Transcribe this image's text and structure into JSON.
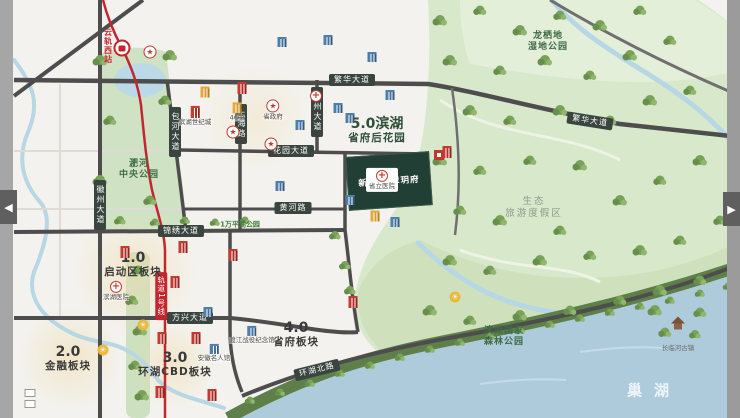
{
  "carousel": {
    "prev_label": "◀",
    "next_label": "▶"
  },
  "lake": {
    "name": "巢湖"
  },
  "project": {
    "name": "新华·翡翠玥府",
    "logo": "新华地产"
  },
  "transit": {
    "station": "云轨西站",
    "line_badge": "轨道1号线",
    "line_color": "#c2262e"
  },
  "zones": [
    {
      "num": "1.0",
      "name": "启动区板块",
      "x": 133,
      "y": 264,
      "color": "#3a3a3a"
    },
    {
      "num": "2.0",
      "name": "金融板块",
      "x": 68,
      "y": 358,
      "color": "#3a3a3a"
    },
    {
      "num": "3.0",
      "name": "环湖CBD板块",
      "x": 175,
      "y": 364,
      "color": "#3a3a3a"
    },
    {
      "num": "4.0",
      "name": "省府板块",
      "x": 296,
      "y": 334,
      "color": "#3a3a3a"
    },
    {
      "num": "5.0滨湖",
      "name": "省府后花园",
      "x": 377,
      "y": 130,
      "color": "#2e4f38"
    }
  ],
  "road_badges": [
    {
      "label": "繁华大道",
      "x": 352,
      "y": 80,
      "angle": 0
    },
    {
      "label": "繁华大道",
      "x": 590,
      "y": 121,
      "angle": 9
    },
    {
      "label": "锦绣大道",
      "x": 181,
      "y": 231,
      "angle": 0
    },
    {
      "label": "花园大道",
      "x": 291,
      "y": 151,
      "angle": 0
    },
    {
      "label": "黄河路",
      "x": 293,
      "y": 208,
      "angle": 0
    },
    {
      "label": "方兴大道",
      "x": 190,
      "y": 318,
      "angle": 0
    },
    {
      "label": "环湖北路",
      "x": 317,
      "y": 370,
      "angle": -14
    }
  ],
  "vertical_roads": [
    {
      "label": "徽州大道",
      "x": 100,
      "y": 205
    },
    {
      "label": "包河大道",
      "x": 175,
      "y": 132
    },
    {
      "label": "上海路",
      "x": 241,
      "y": 124
    },
    {
      "label": "庐州大道",
      "x": 317,
      "y": 112
    }
  ],
  "area_labels": [
    {
      "text": "淝河\n中央公园",
      "x": 139,
      "y": 170,
      "cls": "park"
    },
    {
      "text": "龙栖地\n湿地公园",
      "x": 548,
      "y": 42,
      "cls": "park"
    },
    {
      "text": "生态\n旅游度假区",
      "x": 534,
      "y": 208,
      "cls": "muted"
    },
    {
      "text": "滨湖国家\n森林公园",
      "x": 504,
      "y": 337,
      "cls": "park"
    },
    {
      "text": "1万平湖公园",
      "x": 240,
      "y": 225,
      "cls": "green-sm"
    },
    {
      "text": "长临河古镇",
      "x": 678,
      "y": 348,
      "cls": "tiny"
    }
  ],
  "pois": [
    {
      "type": "star",
      "label": "",
      "x": 150,
      "y": 52
    },
    {
      "type": "star",
      "label": "省政府",
      "x": 273,
      "y": 110
    },
    {
      "type": "star",
      "label": "",
      "x": 233,
      "y": 132
    },
    {
      "type": "star",
      "label": "",
      "x": 271,
      "y": 144
    },
    {
      "type": "cross",
      "label": "",
      "x": 316,
      "y": 96
    },
    {
      "type": "cross",
      "label": "省立医院",
      "x": 382,
      "y": 180,
      "plate": true
    },
    {
      "type": "cross",
      "label": "滨湖医院",
      "x": 116,
      "y": 291
    },
    {
      "type": "school",
      "label": "46中",
      "x": 237,
      "y": 112
    },
    {
      "type": "school",
      "label": "",
      "x": 205,
      "y": 92
    },
    {
      "type": "school",
      "label": "",
      "x": 375,
      "y": 216
    },
    {
      "type": "bldg",
      "label": "滨湖世纪城",
      "x": 195,
      "y": 116
    },
    {
      "type": "bldg",
      "label": "",
      "x": 242,
      "y": 88
    },
    {
      "type": "bldg",
      "label": "",
      "x": 125,
      "y": 252
    },
    {
      "type": "bldg",
      "label": "",
      "x": 183,
      "y": 247
    },
    {
      "type": "bldg",
      "label": "",
      "x": 233,
      "y": 255
    },
    {
      "type": "bldg",
      "label": "",
      "x": 175,
      "y": 282
    },
    {
      "type": "bldg",
      "label": "",
      "x": 162,
      "y": 338
    },
    {
      "type": "bldg",
      "label": "",
      "x": 196,
      "y": 338
    },
    {
      "type": "bldg",
      "label": "",
      "x": 160,
      "y": 392
    },
    {
      "type": "bldg",
      "label": "",
      "x": 212,
      "y": 395
    },
    {
      "type": "bldg",
      "label": "",
      "x": 353,
      "y": 302
    },
    {
      "type": "bldg",
      "label": "",
      "x": 447,
      "y": 152
    },
    {
      "type": "blue",
      "label": "",
      "x": 282,
      "y": 42
    },
    {
      "type": "blue",
      "label": "",
      "x": 328,
      "y": 40
    },
    {
      "type": "blue",
      "label": "",
      "x": 372,
      "y": 57
    },
    {
      "type": "blue",
      "label": "",
      "x": 300,
      "y": 125
    },
    {
      "type": "blue",
      "label": "",
      "x": 350,
      "y": 118
    },
    {
      "type": "blue",
      "label": "",
      "x": 390,
      "y": 95
    },
    {
      "type": "blue",
      "label": "",
      "x": 338,
      "y": 108
    },
    {
      "type": "blue",
      "label": "",
      "x": 350,
      "y": 200
    },
    {
      "type": "blue",
      "label": "",
      "x": 280,
      "y": 186
    },
    {
      "type": "blue",
      "label": "",
      "x": 208,
      "y": 312
    },
    {
      "type": "blue",
      "label": "",
      "x": 395,
      "y": 222
    },
    {
      "type": "blue",
      "label": "渡江战役纪念馆",
      "x": 252,
      "y": 335
    },
    {
      "type": "blue",
      "label": "安徽名人馆",
      "x": 214,
      "y": 353
    },
    {
      "type": "sun",
      "label": "",
      "x": 143,
      "y": 325
    },
    {
      "type": "sun",
      "label": "",
      "x": 455,
      "y": 297
    },
    {
      "type": "sun",
      "label": "",
      "x": 103,
      "y": 350
    },
    {
      "type": "box",
      "label": "",
      "x": 30,
      "y": 393
    },
    {
      "type": "box",
      "label": "",
      "x": 30,
      "y": 404
    },
    {
      "type": "pagoda",
      "label": "",
      "x": 678,
      "y": 320
    }
  ]
}
